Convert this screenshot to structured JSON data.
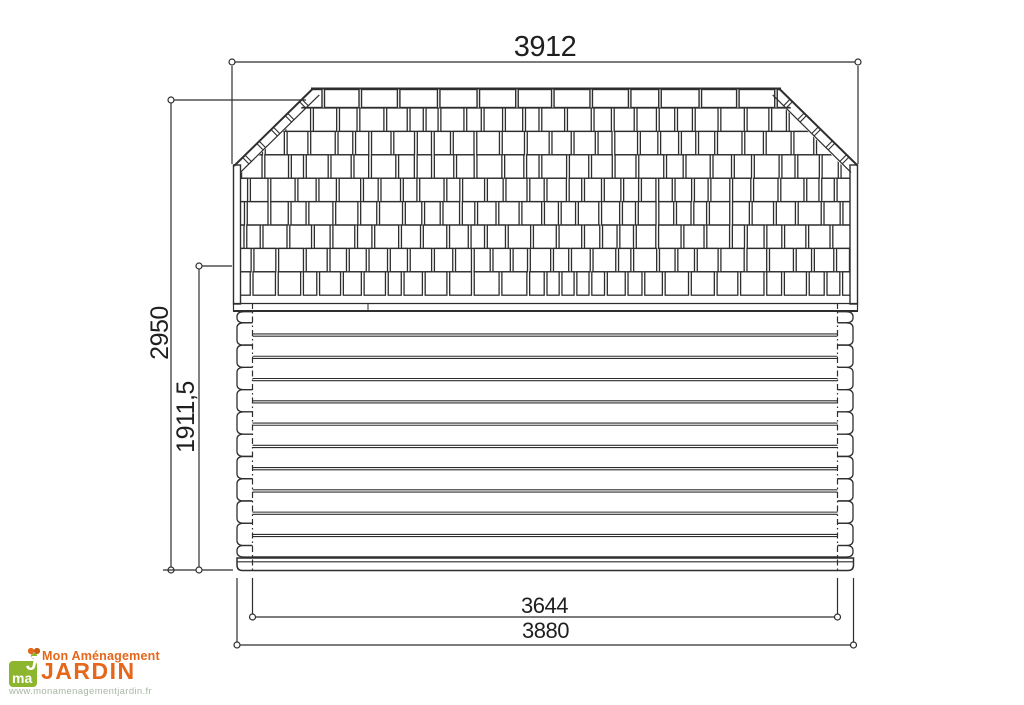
{
  "colors": {
    "background": "#ffffff",
    "line": "#2e2e2e",
    "dim_text": "#1f1f1f",
    "logo_green": "#8db52e",
    "logo_orange": "#e6661a",
    "logo_url_text": "#a8b7a4"
  },
  "dimensions": {
    "roof_width": "3912",
    "overall_height": "2950",
    "wall_height": "1911,5",
    "inner_width": "3644",
    "base_width": "3880"
  },
  "logo": {
    "badge_text": "ma",
    "badge_accent": "J",
    "name_line1": "Mon Aménagement",
    "name_line2": "JARDIN",
    "website": "www.monamenagementjardin.fr"
  }
}
